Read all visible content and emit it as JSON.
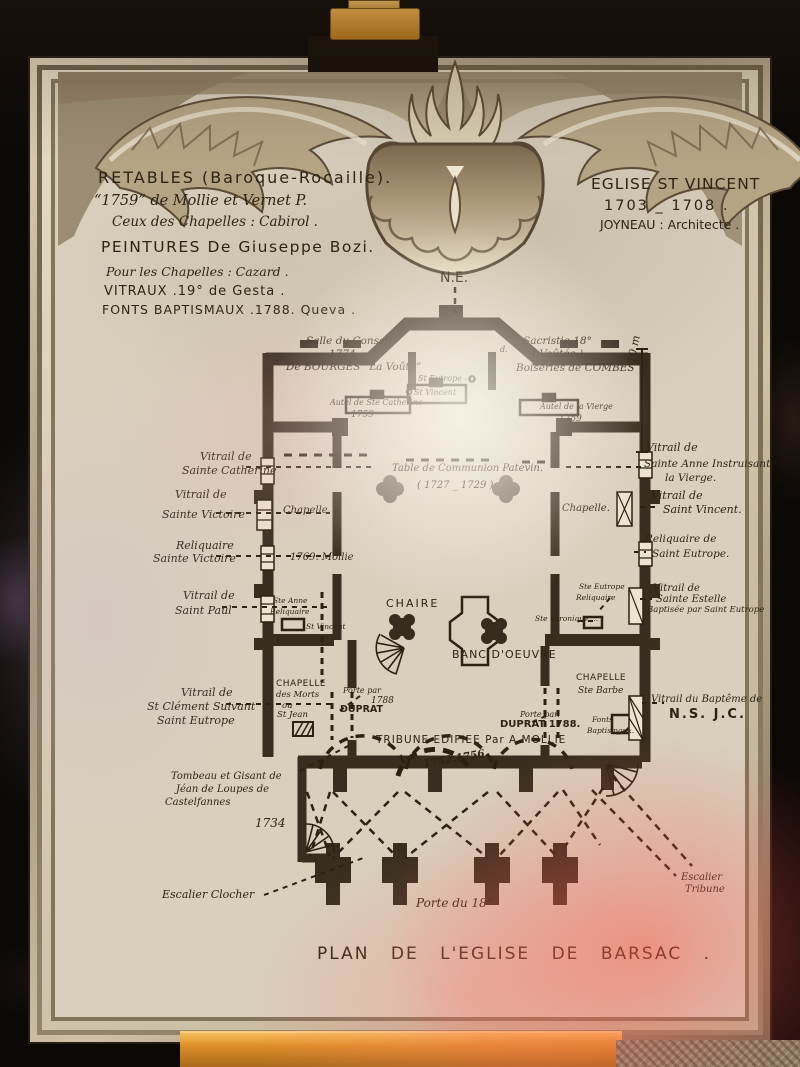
{
  "colors": {
    "ink": "#2b2214",
    "paper": "#d8cfbd",
    "frame_light": "#ded2b6",
    "easel_wood": "#dd8f28",
    "glow_pink": "#ff5a4b"
  },
  "notes_left": {
    "retables_1": "RETABLES (Baroque-Rocaille).",
    "retables_2": "“1759” de Mollie et Vernet P.",
    "retables_3": "Ceux des Chapelles : Cabirol .",
    "peintures_1": "PEINTURES De Giuseppe Bozi.",
    "peintures_2": "Pour les Chapelles : Cazard .",
    "vitraux": "VITRAUX .19° de Gesta .",
    "fonts": "FONTS BAPTISMAUX .1788. Queva ."
  },
  "notes_right": {
    "line1": "EGLISE ST VINCENT",
    "line2": "1703 _ 1708 .",
    "line3": "JOYNEAU : Architecte ."
  },
  "compass_label": "N.E.",
  "scale_label": "10 m",
  "plan": {
    "salle_conseil": {
      "l1": "Salle du Conseil.",
      "l2": "1774",
      "l3": "De BOURGES “La Voûte”"
    },
    "sacristie": {
      "l1": "Sacristie 18°",
      "l2": "( Voûtée )",
      "l3": "Boiseries de COMBES"
    },
    "small_d": "d.",
    "st_eutrope": "St Eutrope - o",
    "st_vincent_apse": "St Vincent",
    "autel_catherine": {
      "l1": "Autel de Ste Catherine",
      "l2": "1759"
    },
    "autel_vierge": {
      "l1": "Autel de la Vierge",
      "l2": "1759"
    },
    "table_communion": {
      "l1": "Table de Communion Patevin.",
      "l2": "( 1727 _ 1729 )"
    },
    "chapelle_left": "Chapelle.",
    "chapelle_right": "Chapelle.",
    "mollie": "1769. Mollie",
    "ste_anne": {
      "l1": "Ste Anne",
      "l2": "Reliquaire"
    },
    "st_vincent_small": "St Vincent",
    "chaire": "CHAIRE",
    "banc": "BANC D'OEUVRE",
    "ste_veronique": "Ste Véronique ...",
    "ste_eutrope_rel": {
      "l1": "Ste Eutrope",
      "l2": "Reliquaire"
    },
    "chapelle_morts": {
      "l1": "CHAPELLE",
      "l2": "des Morts",
      "l3": "ou",
      "l4": "St Jean"
    },
    "porte_duprat_left": {
      "l1": "Porte par",
      "l2": "1788",
      "l3": "DUPRAT"
    },
    "chapelle_barbe": {
      "l1": "CHAPELLE",
      "l2": "Ste Barbe"
    },
    "porte_duprat_right": {
      "l1": "Porte par.",
      "l2": "DUPRAT 1788."
    },
    "fonts_bapt": {
      "l1": "Fonts",
      "l2": "Baptismaux."
    },
    "tribune": {
      "l1": "TRIBUNE EDIFIEE Par A MOLLIE",
      "l2": "1752.1756"
    },
    "date_1734": "1734",
    "porte_18": "Porte du 18°"
  },
  "left_labels": {
    "catherine": {
      "l1": "Vitrail de",
      "l2": "Sainte Catherine"
    },
    "victoire": {
      "l1": "Vitrail de",
      "l2": "Sainte Victoire"
    },
    "reliquaire_victoire": {
      "l1": "Reliquaire",
      "l2": "Sainte Victoire"
    },
    "paul": {
      "l1": "Vitrail de",
      "l2": "Saint Paul"
    },
    "clement": {
      "l1": "Vitrail de",
      "l2": "St Clément Suivant",
      "l3": "Saint Eutrope"
    },
    "tombeau": {
      "l1": "Tombeau et Gisant de",
      "l2": "Jéan de Loupes de",
      "l3": "Castelfannes"
    },
    "escalier_clocher": "Escalier Clocher"
  },
  "right_labels": {
    "ste_anne": {
      "l1": "Vitrail de",
      "l2": "Sainte Anne Instruisant",
      "l3": "la Vierge."
    },
    "st_vincent": {
      "l1": "Vitrail de",
      "l2": "Saint Vincent."
    },
    "reliquaire_eutrope": {
      "l1": "Reliquaire de",
      "l2": "Saint Eutrope."
    },
    "estelle": {
      "l1": "Vitrail de",
      "l2": "Sainte Estelle",
      "l3": "Baptisée par Saint Eutrope"
    },
    "bapteme": {
      "l1": "Vitrail du Baptême de",
      "l2": "N.S. J.C."
    },
    "escalier_tribune": {
      "l1": "Escalier",
      "l2": "Tribune"
    }
  },
  "title": "PLAN DE L'EGLISE DE BARSAC ."
}
